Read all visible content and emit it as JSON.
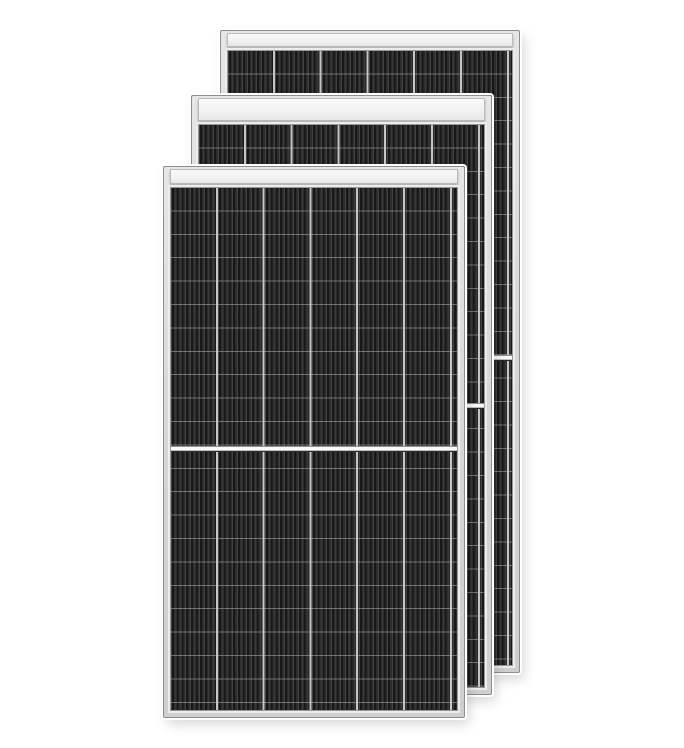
{
  "image": {
    "type": "product-photo",
    "description": "Three black monocrystalline half-cut-cell solar panels with silver aluminium frames, stacked front-to-back in an overlapping diagonal row on a white background"
  },
  "colors": {
    "background": "#ffffff",
    "frame": "#d4d4d4",
    "frame_light": "#e6e6e6",
    "frame_edge": "#8d8d8d",
    "header_band": "#f2f2f2",
    "cell_dark": "#1d1d1d",
    "cell_stripe": "#424242",
    "grid_line": "#c6c6c6",
    "divider_band": "#fafafa"
  },
  "panels": [
    {
      "id": "back",
      "label": "Solar panel, back of stack",
      "columns": 6,
      "rows_visible": 26,
      "divider": "horizontal white band at vertical center",
      "frame_color_name": "silver",
      "cell_color_name": "black"
    },
    {
      "id": "middle",
      "label": "Solar panel, middle of stack",
      "columns": 6,
      "rows_visible": 24,
      "divider": "horizontal white band at vertical center",
      "frame_color_name": "silver",
      "cell_color_name": "black"
    },
    {
      "id": "front",
      "label": "Solar panel, front of stack",
      "columns": 6,
      "rows_visible": 22,
      "divider": "horizontal white band at vertical center",
      "frame_color_name": "silver",
      "cell_color_name": "black"
    }
  ]
}
